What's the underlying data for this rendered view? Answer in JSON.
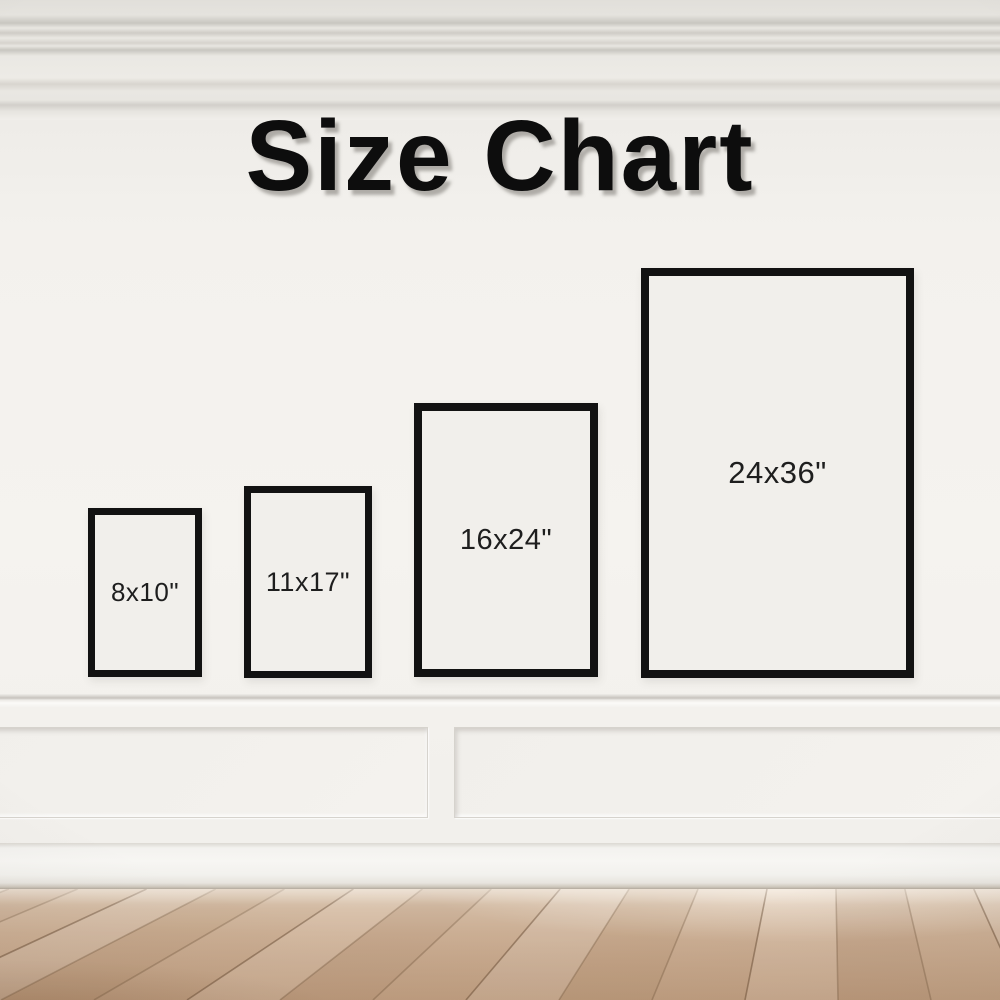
{
  "title": "Size Chart",
  "frames": [
    {
      "label": "8x10\"",
      "width_in": 8,
      "height_in": 10
    },
    {
      "label": "11x17\"",
      "width_in": 11,
      "height_in": 17
    },
    {
      "label": "16x24\"",
      "width_in": 16,
      "height_in": 24
    },
    {
      "label": "24x36\"",
      "width_in": 24,
      "height_in": 36
    }
  ],
  "chart_data": {
    "type": "table",
    "title": "Size Chart",
    "labels": [
      "8x10\"",
      "11x17\"",
      "16x24\"",
      "24x36\""
    ],
    "sizes_inches": [
      [
        8,
        10
      ],
      [
        11,
        17
      ],
      [
        16,
        24
      ],
      [
        24,
        36
      ]
    ]
  },
  "colors": {
    "frame_outline": "#121212",
    "wall": "#f2f0ec",
    "molding": "#e9e7e2",
    "floor_wood": "#c9ab90",
    "title_text": "#0d0d0d",
    "label_text": "#1e1e1e"
  }
}
